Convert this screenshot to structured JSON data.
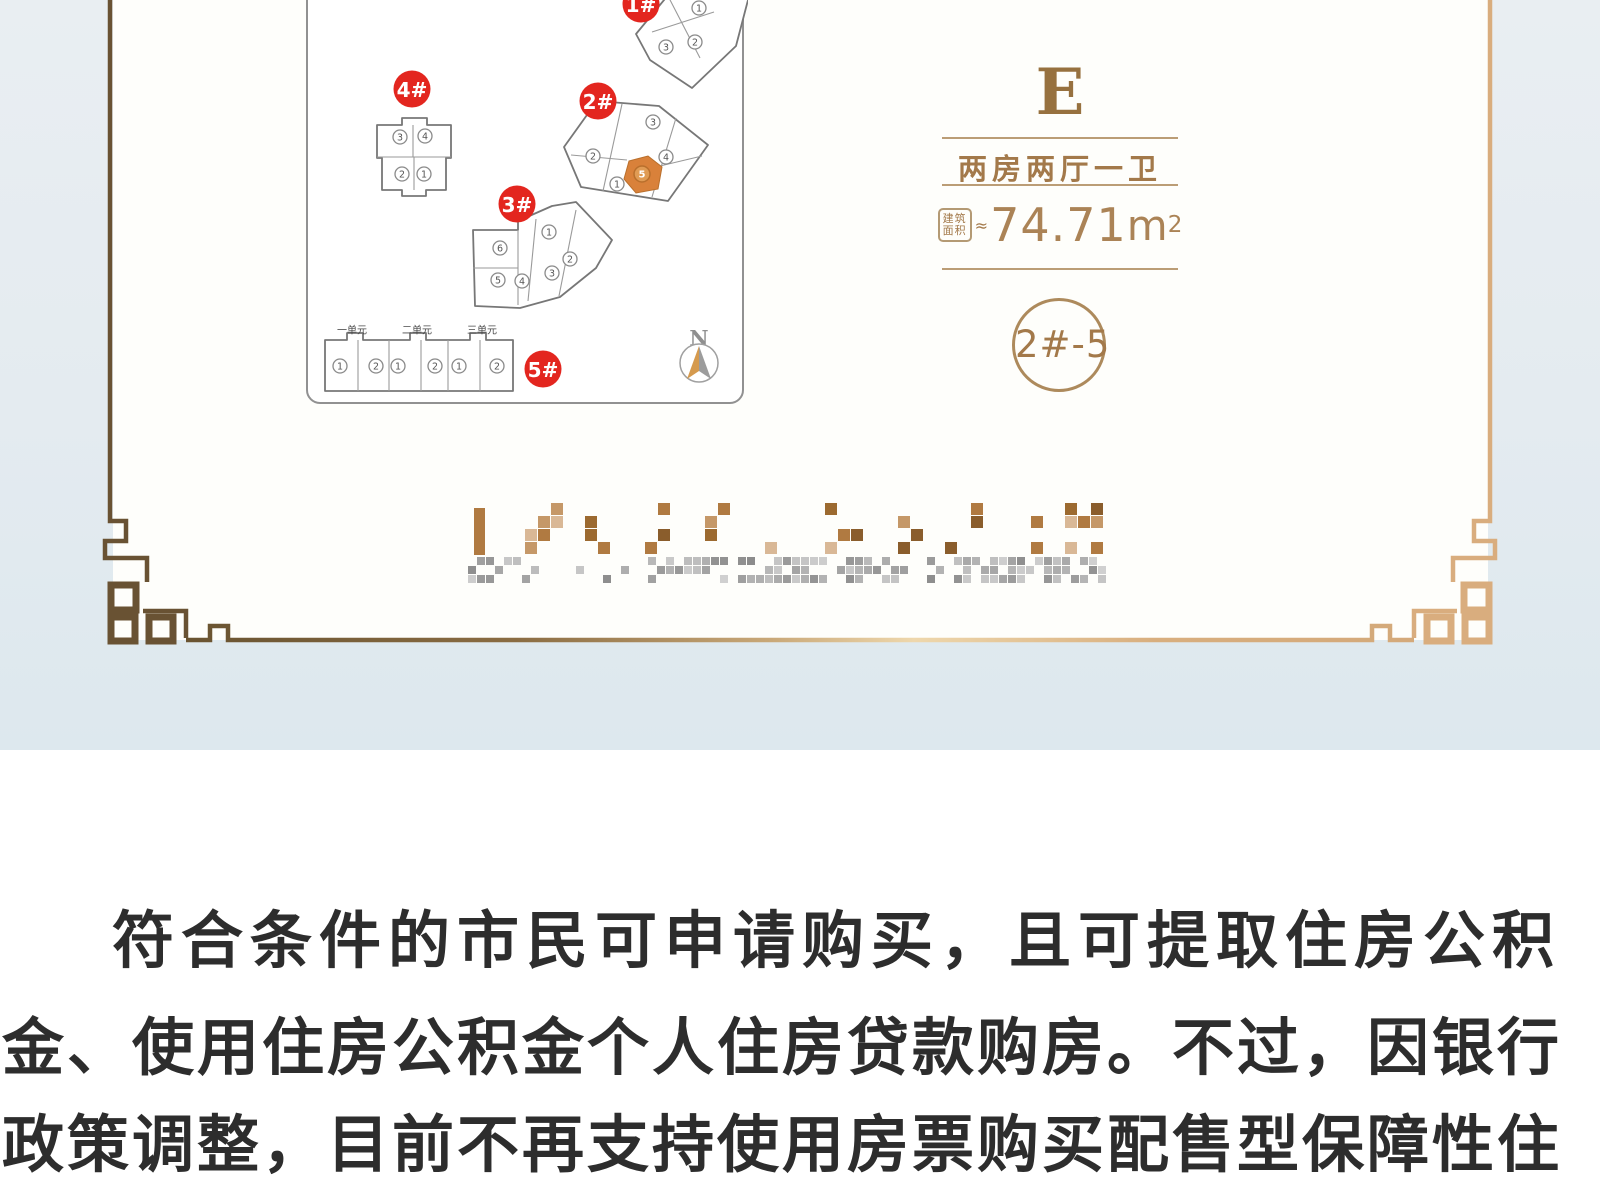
{
  "colors": {
    "badge_red": "#e3261f",
    "unit_highlight": "#d9813a",
    "unit_highlight_circle": "#e09b54",
    "unit_highlight_stroke": "#b96f2c",
    "bronze": "#a3794a",
    "bronze_dark": "#97713f",
    "frame_dark": "#695233",
    "frame_light": "#d9ad7e",
    "body_text": "#2d2d2d",
    "background_blue": "#e4ebf0",
    "building_stroke": "#777777",
    "unit_circle_stroke": "#8a8a8a",
    "unit_number": "#555555"
  },
  "site_plan": {
    "buildings": [
      {
        "label": "1#",
        "badge": [
          641,
          4
        ],
        "outline": [
          [
            636,
            34
          ],
          [
            669,
            -6
          ],
          [
            704,
            -24
          ],
          [
            744,
            -24
          ],
          [
            748,
            0
          ],
          [
            736,
            46
          ],
          [
            692,
            88
          ],
          [
            650,
            60
          ]
        ],
        "inner": [
          [
            [
              668,
              -4
            ],
            [
              700,
              58
            ]
          ],
          [
            [
              652,
              32
            ],
            [
              714,
              12
            ]
          ]
        ],
        "units": [
          {
            "n": "1",
            "x": 699,
            "y": 8
          },
          {
            "n": "3",
            "x": 666,
            "y": 47
          },
          {
            "n": "2",
            "x": 695,
            "y": 42
          }
        ]
      },
      {
        "label": "2#",
        "badge": [
          598,
          101
        ],
        "outline": [
          [
            597,
            101
          ],
          [
            659,
            106
          ],
          [
            708,
            145
          ],
          [
            668,
            201
          ],
          [
            581,
            187
          ],
          [
            564,
            147
          ]
        ],
        "inner": [
          [
            [
              622,
              104
            ],
            [
              603,
              191
            ]
          ],
          [
            [
              676,
              118
            ],
            [
              652,
              197
            ]
          ],
          [
            [
              571,
              155
            ],
            [
              627,
              160
            ]
          ],
          [
            [
              660,
              166
            ],
            [
              702,
              156
            ]
          ]
        ],
        "units": [
          {
            "n": "3",
            "x": 653,
            "y": 122
          },
          {
            "n": "2",
            "x": 593,
            "y": 156
          },
          {
            "n": "4",
            "x": 666,
            "y": 157
          },
          {
            "n": "1",
            "x": 617,
            "y": 184
          }
        ],
        "highlight": {
          "poly": [
            [
              629,
              161
            ],
            [
              648,
              156
            ],
            [
              662,
              167
            ],
            [
              658,
              189
            ],
            [
              636,
              193
            ],
            [
              624,
              179
            ]
          ],
          "unit": {
            "n": "5",
            "x": 642,
            "y": 174
          }
        }
      },
      {
        "label": "3#",
        "badge": [
          517,
          204
        ],
        "outline": [
          [
            473,
            230
          ],
          [
            518,
            230
          ],
          [
            518,
            221
          ],
          [
            552,
            206
          ],
          [
            576,
            202
          ],
          [
            612,
            240
          ],
          [
            596,
            268
          ],
          [
            560,
            297
          ],
          [
            520,
            308
          ],
          [
            475,
            306
          ]
        ],
        "inner": [
          [
            [
              518,
              230
            ],
            [
              518,
              305
            ]
          ],
          [
            [
              536,
              219
            ],
            [
              528,
              301
            ]
          ],
          [
            [
              576,
              210
            ],
            [
              559,
              296
            ]
          ],
          [
            [
              473,
              268
            ],
            [
              518,
              268
            ]
          ]
        ],
        "units": [
          {
            "n": "6",
            "x": 500,
            "y": 248
          },
          {
            "n": "1",
            "x": 549,
            "y": 232
          },
          {
            "n": "5",
            "x": 498,
            "y": 280
          },
          {
            "n": "4",
            "x": 522,
            "y": 281
          },
          {
            "n": "3",
            "x": 552,
            "y": 273
          },
          {
            "n": "2",
            "x": 570,
            "y": 259
          }
        ]
      },
      {
        "label": "4#",
        "badge": [
          412,
          89
        ],
        "outline": [
          [
            377,
            125
          ],
          [
            402,
            125
          ],
          [
            402,
            118
          ],
          [
            427,
            118
          ],
          [
            427,
            125
          ],
          [
            451,
            125
          ],
          [
            451,
            158
          ],
          [
            446,
            158
          ],
          [
            446,
            190
          ],
          [
            426,
            190
          ],
          [
            426,
            196
          ],
          [
            402,
            196
          ],
          [
            402,
            190
          ],
          [
            382,
            190
          ],
          [
            382,
            158
          ],
          [
            377,
            158
          ]
        ],
        "inner": [
          [
            [
              377,
              157
            ],
            [
              451,
              157
            ]
          ],
          [
            [
              413,
              125
            ],
            [
              413,
              157
            ]
          ],
          [
            [
              414,
              157
            ],
            [
              414,
              190
            ]
          ]
        ],
        "units": [
          {
            "n": "3",
            "x": 400,
            "y": 137
          },
          {
            "n": "4",
            "x": 425,
            "y": 136
          },
          {
            "n": "2",
            "x": 402,
            "y": 174
          },
          {
            "n": "1",
            "x": 424,
            "y": 174
          }
        ]
      },
      {
        "label": "5#",
        "badge": [
          543,
          369
        ],
        "outline": [
          [
            325,
            340
          ],
          [
            347,
            340
          ],
          [
            347,
            333
          ],
          [
            363,
            333
          ],
          [
            363,
            340
          ],
          [
            410,
            340
          ],
          [
            410,
            333
          ],
          [
            426,
            333
          ],
          [
            426,
            340
          ],
          [
            470,
            340
          ],
          [
            470,
            333
          ],
          [
            486,
            333
          ],
          [
            486,
            340
          ],
          [
            513,
            340
          ],
          [
            513,
            391
          ],
          [
            325,
            391
          ]
        ],
        "inner": [
          [
            [
              358,
              340
            ],
            [
              358,
              391
            ]
          ],
          [
            [
              389,
              340
            ],
            [
              389,
              391
            ]
          ],
          [
            [
              421,
              340
            ],
            [
              421,
              391
            ]
          ],
          [
            [
              448,
              340
            ],
            [
              448,
              391
            ]
          ],
          [
            [
              480,
              340
            ],
            [
              480,
              391
            ]
          ]
        ],
        "units": [
          {
            "n": "1",
            "x": 340,
            "y": 366
          },
          {
            "n": "2",
            "x": 376,
            "y": 366
          },
          {
            "n": "1",
            "x": 398,
            "y": 366
          },
          {
            "n": "2",
            "x": 435,
            "y": 366
          },
          {
            "n": "1",
            "x": 459,
            "y": 366
          },
          {
            "n": "2",
            "x": 497,
            "y": 366
          }
        ]
      }
    ],
    "unit_section_labels": [
      {
        "text": "一单元",
        "x": 352,
        "y": 330
      },
      {
        "text": "二单元",
        "x": 417,
        "y": 330
      },
      {
        "text": "三单元",
        "x": 482,
        "y": 330
      }
    ],
    "compass": {
      "label": "N",
      "x": 699,
      "y": 360
    }
  },
  "info_panel": {
    "type_letter": "E",
    "type_name": "两房两厅一卫",
    "area_badge_line1": "建筑",
    "area_badge_line2": "面积",
    "approx_symbol": "≈",
    "area_value": "74.71",
    "area_unit": "m",
    "area_superscript": "2",
    "unit_code": "2#-5"
  },
  "mosaic": {
    "logo_row": {
      "x": 465,
      "y": 503,
      "clusters": 11,
      "spacing": 60,
      "cell": 13,
      "rows": 4,
      "cols": 3,
      "density": 0.34,
      "seed": 9,
      "colors": [
        "#9c6a30",
        "#b07a41",
        "#8a5d2c",
        "#c59868",
        "#d9b896"
      ]
    },
    "text_row": {
      "x": 468,
      "y": 557,
      "width": 648,
      "cell": 9,
      "rows": 3,
      "density": 0.5,
      "seed": 23
    }
  },
  "paragraph": {
    "lines": [
      "符合条件的市民可申请购买，且可提取住房公积",
      "金、使用住房公积金个人住房贷款购房。不过，因银行",
      "政策调整，目前不再支持使用房票购买配售型保障性住"
    ]
  }
}
